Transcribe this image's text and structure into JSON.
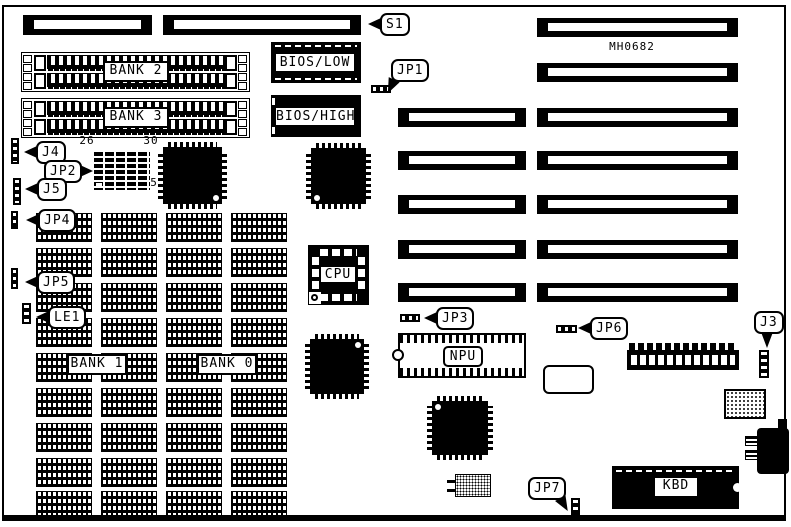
{
  "diagram": {
    "board_code": "MH0682",
    "colors": {
      "ink": "#000000",
      "paper": "#ffffff"
    },
    "callouts": {
      "s1": "S1",
      "jp1": "JP1",
      "j4": "J4",
      "jp2": "JP2",
      "j5": "J5",
      "jp4": "JP4",
      "jp5": "JP5",
      "le1": "LE1",
      "jp3": "JP3",
      "jp6": "JP6",
      "j3": "J3",
      "jp7": "JP7"
    },
    "chips": {
      "bios_low": "BIOS/LOW",
      "bios_high": "BIOS/HIGH",
      "cpu": "CPU",
      "npu": "NPU",
      "kbd": "KBD"
    },
    "banks": {
      "bank0": "BANK 0",
      "bank1": "BANK 1",
      "bank2": "BANK 2",
      "bank3": "BANK 3"
    },
    "jp2_pins": {
      "top_left": "26",
      "top_right": "30",
      "bottom_right": "5"
    }
  }
}
